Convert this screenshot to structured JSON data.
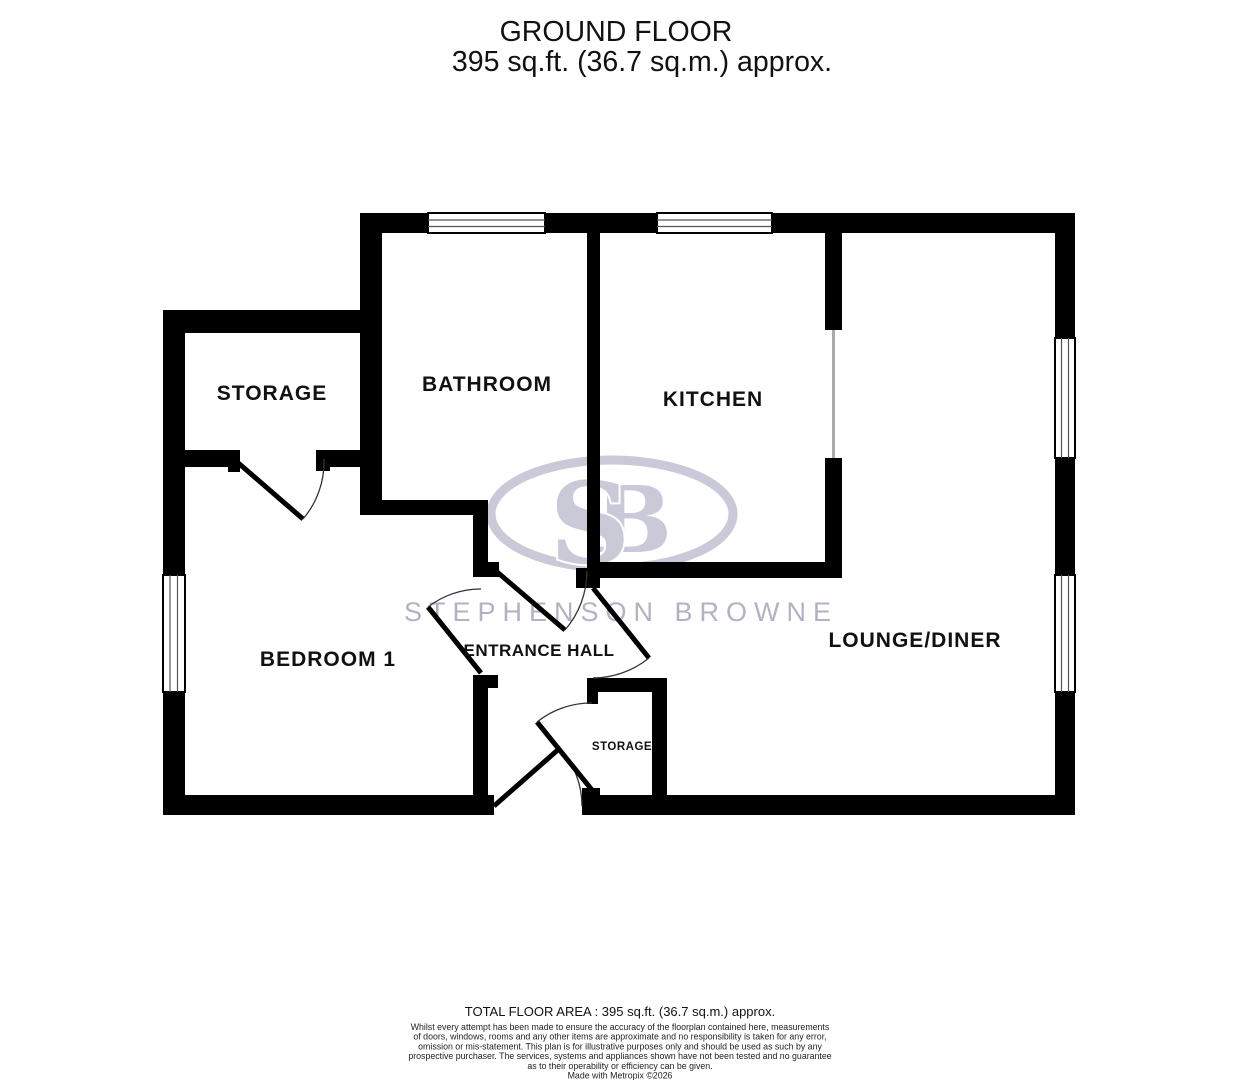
{
  "title": {
    "line1": "GROUND FLOOR",
    "line2": "395 sq.ft. (36.7 sq.m.) approx."
  },
  "rooms": {
    "storage_main": {
      "label": "STORAGE"
    },
    "bathroom": {
      "label": "BATHROOM"
    },
    "kitchen": {
      "label": "KITCHEN"
    },
    "bedroom1": {
      "label": "BEDROOM 1"
    },
    "entrance_hall": {
      "label": "ENTRANCE HALL"
    },
    "lounge_diner": {
      "label": "LOUNGE/DINER"
    },
    "storage_small": {
      "label": "STORAGE"
    }
  },
  "watermark": {
    "monogram_s": "S",
    "monogram_b": "B",
    "wordmark": "STEPHENSON BROWNE"
  },
  "footer": {
    "total_area": "TOTAL FLOOR AREA : 395 sq.ft. (36.7 sq.m.) approx.",
    "disclaimer": [
      "Whilst every attempt has been made to ensure the accuracy of the floorplan contained here, measurements",
      "of doors, windows, rooms and any other items are approximate and no responsibility is taken for any error,",
      "omission or mis-statement. This plan is for illustrative purposes only and should be used as such by any",
      "prospective purchaser. The services, systems and appliances shown have not been tested and no guarantee",
      "as to their operability or efficiency can be given."
    ],
    "credit": "Made with Metropix ©2026"
  },
  "colors": {
    "wall": "#000000",
    "watermark_logo": "#c9c9d8",
    "watermark_text": "#b2b2c2",
    "label_text": "#111111"
  }
}
